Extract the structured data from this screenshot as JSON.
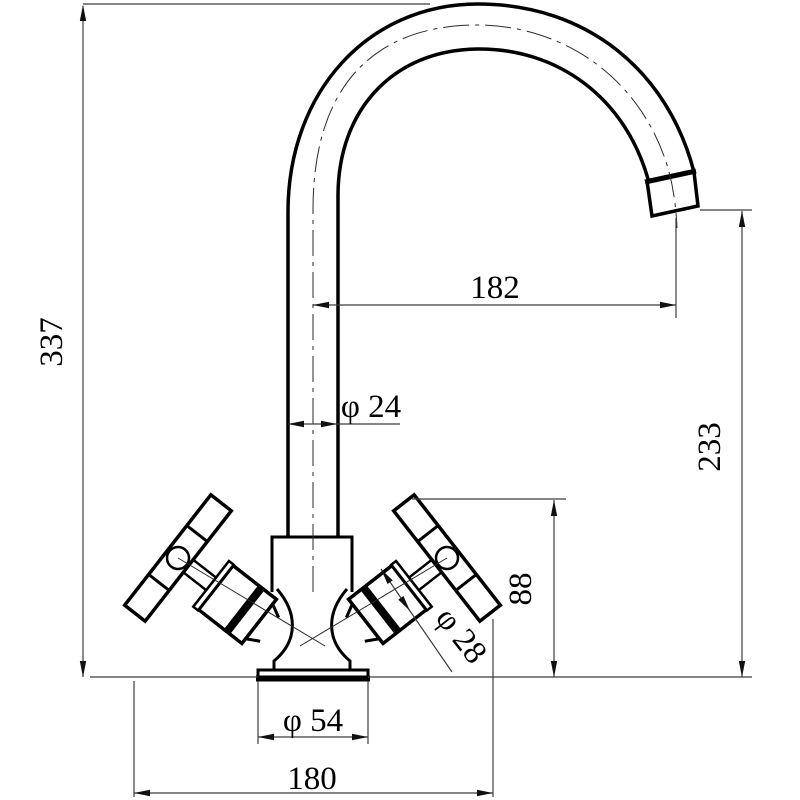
{
  "drawing": {
    "type": "technical-drawing",
    "subject": "kitchen-mixer-tap-front-elevation",
    "background_color": "#ffffff",
    "line_color": "#000000",
    "dim_line_color": "#3c3c3c"
  },
  "dimensions": {
    "overall_height": {
      "label": "337",
      "meaning": "overall height of tap"
    },
    "spout_reach": {
      "label": "182",
      "meaning": "horizontal reach from pipe centerline to spout outlet"
    },
    "pipe_diameter": {
      "label": "φ 24",
      "meaning": "spout pipe diameter"
    },
    "spout_height": {
      "label": "233",
      "meaning": "height from base to spout outlet"
    },
    "handle_height": {
      "label": "88",
      "meaning": "height of handle top above base"
    },
    "valve_diameter": {
      "label": "φ 28",
      "meaning": "valve body diameter"
    },
    "base_diameter": {
      "label": "φ 54",
      "meaning": "base flange diameter"
    },
    "overall_width": {
      "label": "180",
      "meaning": "overall width across handles"
    }
  }
}
